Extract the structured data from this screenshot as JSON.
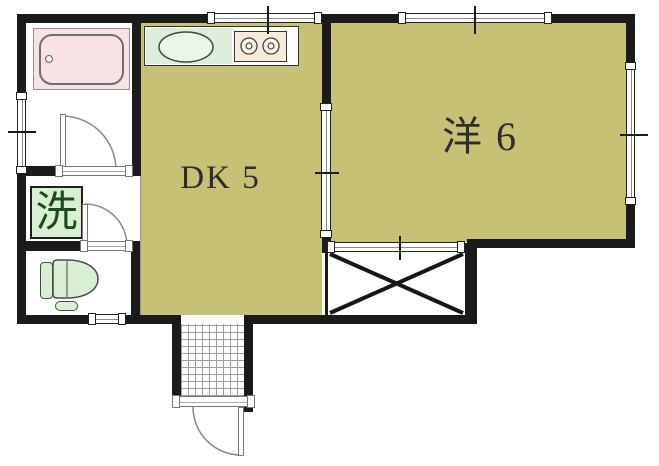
{
  "plan": {
    "type": "apartment-floor-plan",
    "labels": {
      "dining_kitchen": "DK 5",
      "western_room": "洋 6",
      "laundry": "洗"
    }
  },
  "colors": {
    "wall": "#1b1b1b",
    "room-fill": "#c7c175",
    "tub-fill": "#f8e2e4",
    "sink-fill": "#ddefdb",
    "fixture-fill": "#d9efd3",
    "stove-fill": "#f6ecd9",
    "door-stroke": "#8a8a8a",
    "label-color": "#2d2d2d",
    "laundry-text": "#1d4a1d"
  }
}
